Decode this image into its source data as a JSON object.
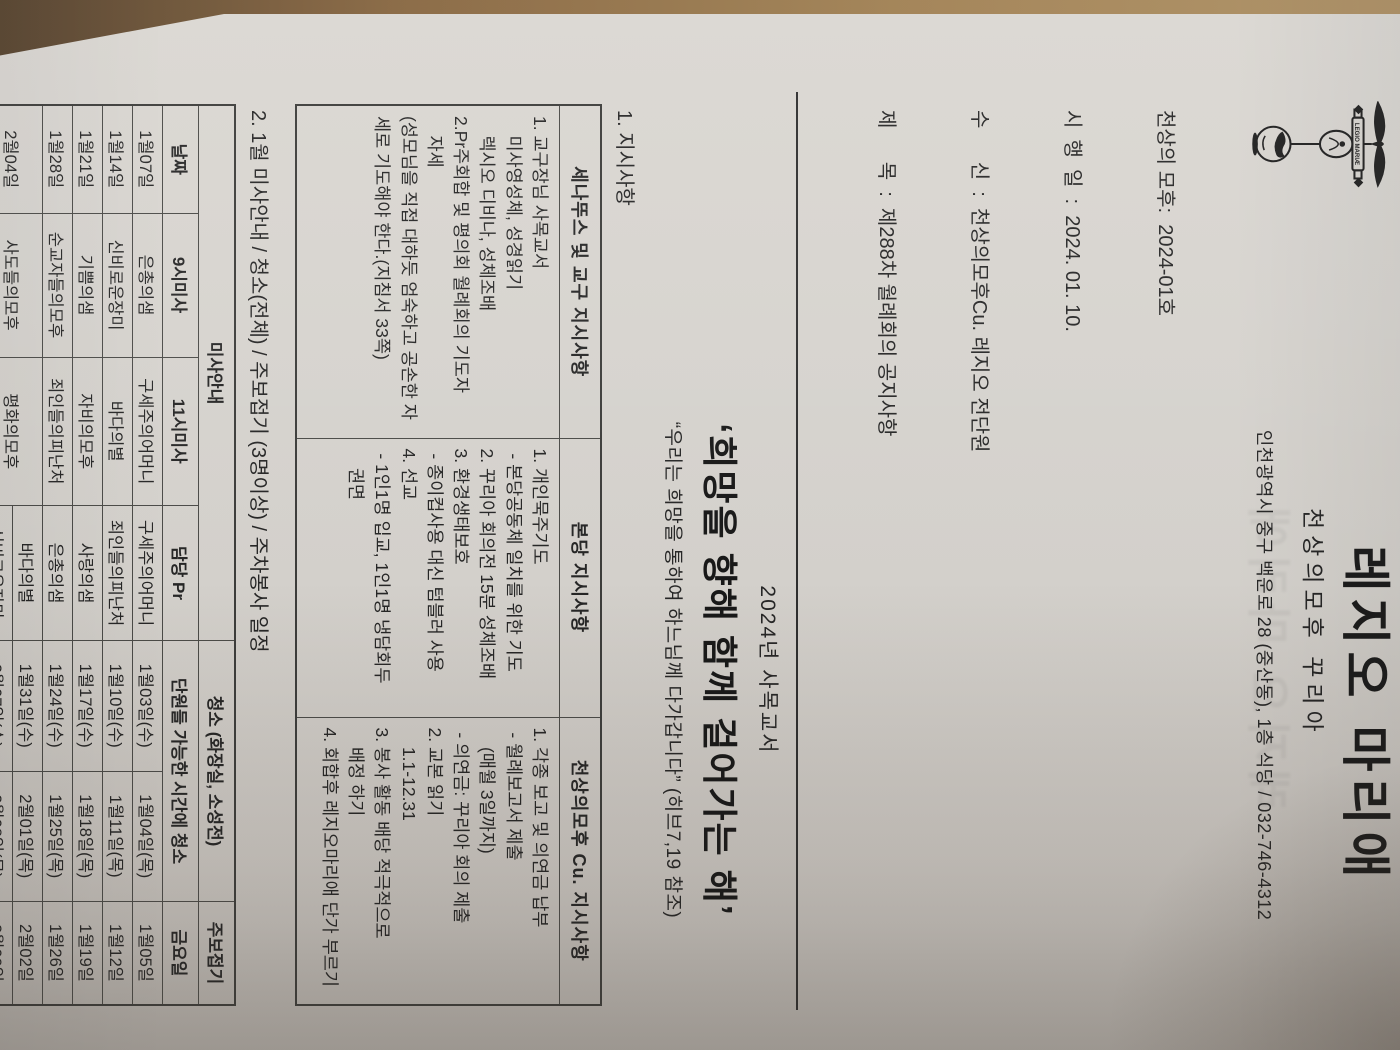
{
  "letterhead": {
    "title": "레지오 마리애",
    "subtitle": "천상의모후 꾸리아",
    "address": "인천광역시 중구 백운로 28 (중산동), 1층 식당 / 032-746-4312",
    "emblem_icon": "legion-vexillum-emblem",
    "doc_no_line": "천상의 모후:  2024-01호",
    "date_line": "시  행  일  :  2024. 01. 10.",
    "to_line": "수      신  :  천상의모후Cu. 레지오 전단원",
    "subject_line": "제      목  :  제288차 월례회의 공지사항"
  },
  "pastoral": {
    "year_line": "2024년 사목교서",
    "slogan": "‘희망을 향해 함께 걸어가는 해’",
    "quote": "“우리는 희망을 통하여 하느님께 다가갑니다” (히브7,19 참조)"
  },
  "section1": {
    "heading": "1. 지시사항",
    "headers": [
      "세나뚜스 및 교구 지시사항",
      "본당 지시사항",
      "천상의모후 Cu. 지시사항"
    ],
    "col1": "1. 교구장님 사목교서\n    미사영성체, 성경읽기\n    렉시오 디비나, 성체조배\n2.Pr주회합 및 평의회 월례회의 기도자\n    자세\n(성모님을 직접 대하듯 엄숙하고 공손한 자\n세로 기도해야 한다.(지침서 33쪽)",
    "col2": "1. 개인묵주기도\n - 본당공동체 일치를 위한 기도\n2. 꾸리아 회의전 15분 성체조배\n3. 환경생태보호\n - 종이컵사용 대신 텀블러 사용\n4. 선교\n - 1인1명 입교, 1인1명 냉담회두\n    권면",
    "col3": "1. 각종 보고 및 의연금 납부\n - 월례보고서 제출\n    (매월 3일까지)\n - 의연금: 꾸리아 회의 제출\n2. 교본 읽기\n    1.1-12.31\n3. 봉사 활동 배당 적극적으로\n    배정 하기\n4. 회합후 레지오마리애 단가 부르기"
  },
  "section2": {
    "heading": "2. 1월 미사안내 / 청소(전체) / 주보접기 (3명이상) / 주차봉사 일정",
    "group_headers": {
      "mass": "미사안내",
      "clean": "청소 (화장실, 소성전)",
      "bulletin": "주보접기"
    },
    "col_headers": {
      "date": "날짜",
      "m9": "9시미사",
      "m11": "11시미사",
      "pr": "담당 Pr",
      "clean_sub": "단원들 가능한 시간에 청소",
      "friday": "금요일"
    },
    "rows": [
      {
        "date": "1월07일",
        "m9": "은총의샘",
        "m11": "구세주의어머니",
        "pr": "구세주의어머니",
        "c1": "1월03일(수)",
        "c2": "1월04일(목)",
        "fri": "1월05일"
      },
      {
        "date": "1월14일",
        "m9": "신비로운장미",
        "m11": "바다의별",
        "pr": "죄인들의피난처",
        "c1": "1월10일(수)",
        "c2": "1월11일(목)",
        "fri": "1월12일"
      },
      {
        "date": "1월21일",
        "m9": "기쁨의샘",
        "m11": "자비의모후",
        "pr": "사랑의샘",
        "c1": "1월17일(수)",
        "c2": "1월18일(목)",
        "fri": "1월19일"
      },
      {
        "date": "1월28일",
        "m9": "순교자들의모후",
        "m11": "죄인들의피난처",
        "pr": "은총의샘",
        "c1": "1월24일(수)",
        "c2": "1월25일(목)",
        "fri": "1월26일"
      },
      {
        "date": "2월04일",
        "m9": "사도들의모후",
        "m11": "평화의모후",
        "pr": "바다의별",
        "c1": "1월31일(수)",
        "c2": "2월01일(목)",
        "fri": "2월02일"
      },
      {
        "pr": "신비로운장미",
        "c1": "2월07일(수)",
        "c2": "2월08일(목)",
        "fri": "2월09일"
      }
    ],
    "notes": [
      "★ 성모신심미사 (매월 첫주 토) : 자비의 모후,  기쁨의샘(성모동산 전담)",
      "★ 성체조배실 & 2층 복도 전담 : 가정의 모후 ★ 각방&쓰레기통 비우기 : 평화의 모후"
    ]
  },
  "section3": {
    "title": "1월 주차 봉사",
    "col_headers": {
      "mass_time": "미사일·시",
      "praesidium": "빠레시디움"
    },
    "rows": [
      {
        "date": "1월07일",
        "time": "09시",
        "pr": "사도들,천주성모",
        "date2": "1월28일",
        "time2": "09시",
        "pr2": "사도들,천주성모"
      },
      {
        "time": "11시",
        "pr": "영원한도움의성모",
        "time2": "11시",
        "pr2": "성모성심"
      },
      {
        "date": "1월14일",
        "time": "09시",
        "pr": "사도들,천주성모",
        "date2": "2월04일",
        "time2": "09시",
        "pr2": "사도들,천주성모"
      },
      {
        "time": "11시",
        "pr": "성모성심",
        "time2": "11시",
        "pr2": "영원한도움의성모"
      },
      {
        "date": "1월21일",
        "time": "09시",
        "pr": "사도들,천주성모",
        "date2": "2월11일",
        "time2": "09시",
        "pr2": "사도들,천주성모"
      },
      {
        "time": "11시",
        "pr": "영원한도움의성모",
        "time2": "11시",
        "pr2": "성모성심"
      }
    ]
  },
  "page_number": "- 1 -",
  "colors": {
    "table_wood": "#8a6a45",
    "paper": "#d3d0cb",
    "ink": "#262626"
  }
}
